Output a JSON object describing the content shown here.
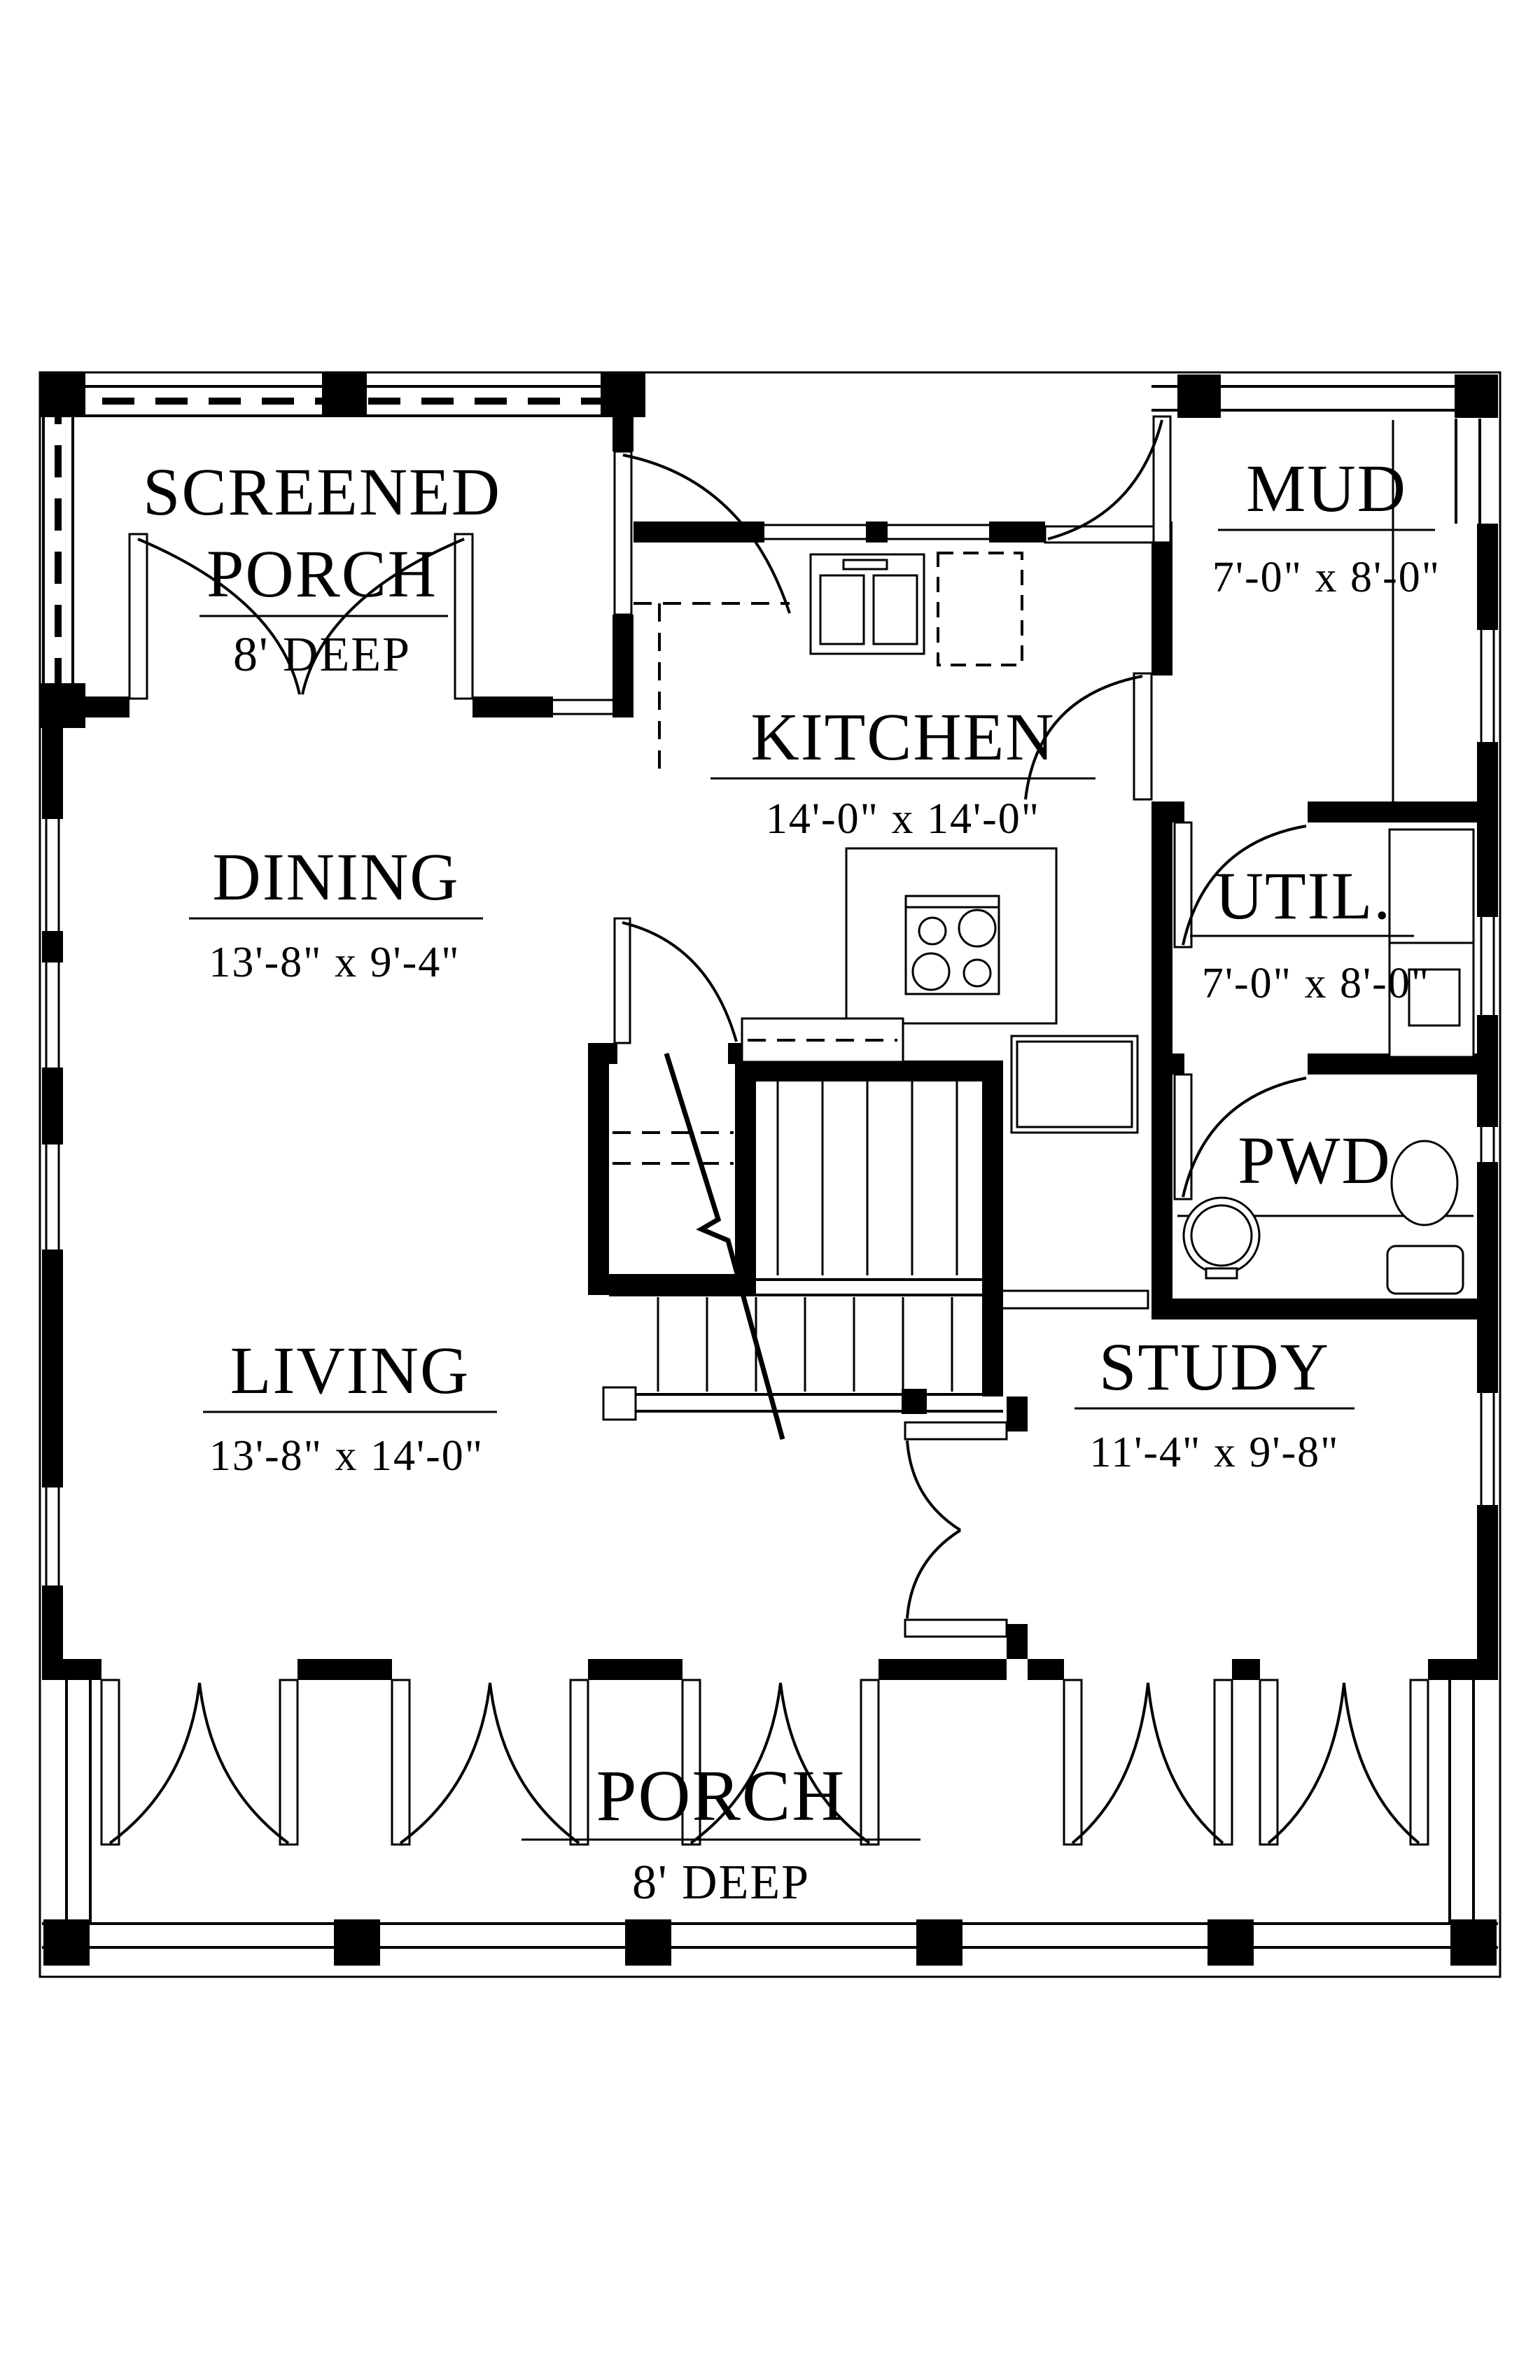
{
  "colors": {
    "ink": "#000000",
    "paper": "#ffffff"
  },
  "rooms": {
    "screened_porch": {
      "line1": "SCREENED",
      "line2": "PORCH",
      "deep": "8' DEEP"
    },
    "kitchen": {
      "name": "KITCHEN",
      "dims": "14'-0\" x 14'-0\""
    },
    "mud": {
      "name": "MUD",
      "dims": "7'-0\" x 8'-0\""
    },
    "dining": {
      "name": "DINING",
      "dims": "13'-8\" x 9'-4\""
    },
    "util": {
      "name": "UTIL.",
      "dims": "7'-0\" x 8'-0\""
    },
    "pwd": {
      "name": "PWD"
    },
    "living": {
      "name": "LIVING",
      "dims": "13'-8\" x 14'-0\""
    },
    "study": {
      "name": "STUDY",
      "dims": "11'-4\" x 9'-8\""
    },
    "porch": {
      "name": "PORCH",
      "deep": "8' DEEP"
    }
  }
}
